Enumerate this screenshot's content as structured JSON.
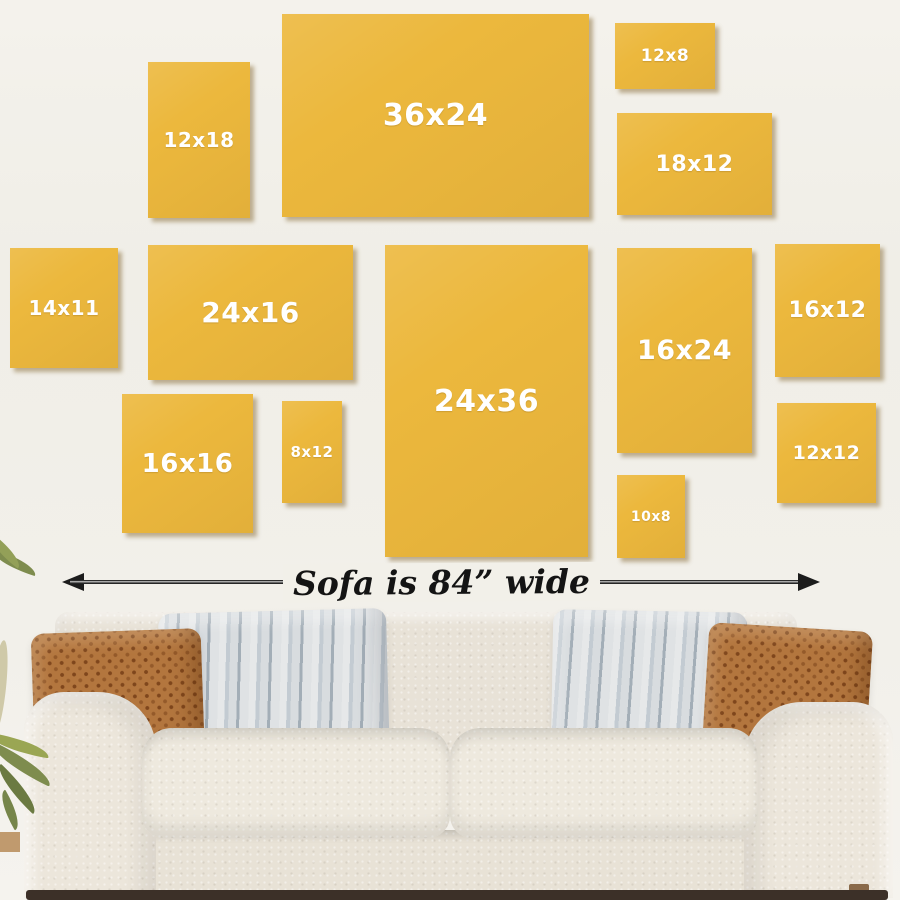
{
  "frames": [
    {
      "label": "12x18",
      "width_in": 12,
      "height_in": 18
    },
    {
      "label": "36x24",
      "width_in": 36,
      "height_in": 24
    },
    {
      "label": "12x8",
      "width_in": 12,
      "height_in": 8
    },
    {
      "label": "18x12",
      "width_in": 18,
      "height_in": 12
    },
    {
      "label": "14x11",
      "width_in": 14,
      "height_in": 11
    },
    {
      "label": "24x16",
      "width_in": 24,
      "height_in": 16
    },
    {
      "label": "24x36",
      "width_in": 24,
      "height_in": 36
    },
    {
      "label": "16x24",
      "width_in": 16,
      "height_in": 24
    },
    {
      "label": "16x12",
      "width_in": 16,
      "height_in": 12
    },
    {
      "label": "16x16",
      "width_in": 16,
      "height_in": 16
    },
    {
      "label": "8x12",
      "width_in": 8,
      "height_in": 12
    },
    {
      "label": "10x8",
      "width_in": 10,
      "height_in": 8
    },
    {
      "label": "12x12",
      "width_in": 12,
      "height_in": 12
    }
  ],
  "arrow": {
    "label": "Sofa is 84” wide"
  },
  "icons": {
    "arrow_left": "◀",
    "arrow_right": "▶"
  },
  "colors": {
    "background": "#f1efe8",
    "frame": "#ecb83d",
    "frame_text": "#ffffff",
    "frame_shadow": "#7a5c22",
    "arrow": "#1c1c1c",
    "sofa_fabric": "#e8e2d7",
    "pillow_rust": "#b3763e",
    "pillow_gray": "#c9d0d5",
    "plant": "#7e8c4e",
    "floor_shadow": "#3c3028"
  }
}
